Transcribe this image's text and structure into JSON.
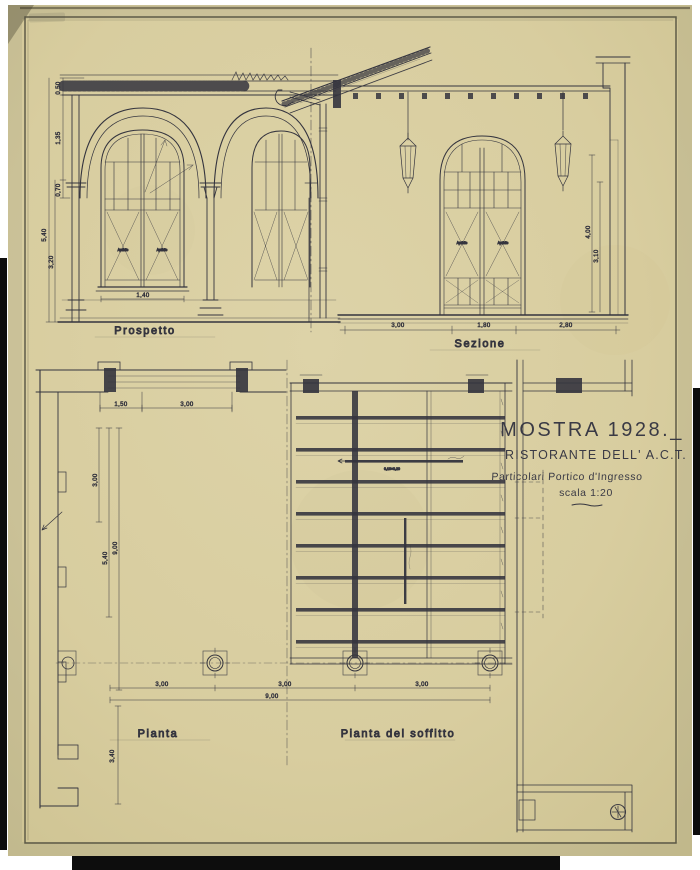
{
  "sheet": {
    "title_block": {
      "title": "MOSTRA 1928._",
      "subtitle": "RISTORANTE DELL' A.C.T.",
      "description": "Particolari Portico d'Ingresso",
      "scale": "scala 1:20"
    },
    "views": [
      {
        "id": "prospetto",
        "label": "Prospetto"
      },
      {
        "id": "sezione",
        "label": "Sezione"
      },
      {
        "id": "pianta",
        "label": "Pianta"
      },
      {
        "id": "soffitto",
        "label": "Pianta del soffitto"
      }
    ]
  },
  "dimensions": {
    "prospetto": {
      "left_chain": [
        "0,50",
        "1,35",
        "0,70",
        "5,40",
        "3,20"
      ],
      "window_width": "1,40"
    },
    "sezione": {
      "bottom_chain": [
        "3,00",
        "1,80",
        "2,80"
      ],
      "right_chain": [
        "4,00",
        "3,10"
      ]
    },
    "pianta": {
      "top_chain": [
        "1,50",
        "3,00"
      ],
      "left_chain": [
        "3,00",
        "5,40",
        "9,00"
      ],
      "bottom_chain": [
        "3,00",
        "3,00",
        "3,00"
      ],
      "bottom_total": "9,00",
      "left_lower": "3,40"
    }
  },
  "annotations": {
    "window_pane_label": "Apribile",
    "beam_size_note": "0,10×0,20"
  },
  "icons": {
    "registration_mark": "circled-cross"
  },
  "colors": {
    "paper": "#d9cfa2",
    "ink": "#34343e",
    "faint_line": "#8d8874",
    "photo_edge": "#0d0d0d"
  }
}
